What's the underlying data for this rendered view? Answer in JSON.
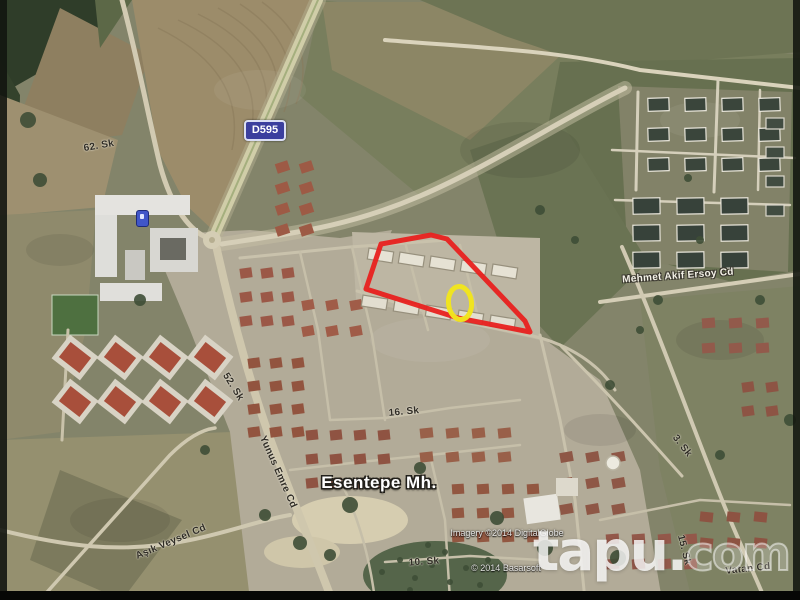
{
  "map": {
    "route_badge": {
      "label": "D595",
      "bg_color": "#3b3f9e"
    },
    "neighborhood": {
      "label": "Esentepe Mh."
    },
    "streets": [
      {
        "id": "62-sk",
        "label": "62. Sk"
      },
      {
        "id": "52-sk",
        "label": "52. Sk"
      },
      {
        "id": "yunus-emre",
        "label": "Yunus Emre Cd"
      },
      {
        "id": "16-sk",
        "label": "16. Sk"
      },
      {
        "id": "10-sk",
        "label": "10. Sk"
      },
      {
        "id": "asik-veysel",
        "label": "Aşık Veysel Cd"
      },
      {
        "id": "mehmet-akif",
        "label": "Mehmet Akif Ersoy Cd"
      },
      {
        "id": "3-sk",
        "label": "3. Sk"
      },
      {
        "id": "15-sk",
        "label": "15. Sk"
      },
      {
        "id": "vatan",
        "label": "Vatan Cd"
      }
    ],
    "annotations": {
      "parcel_outline_color": "#e8211f",
      "marker_ring_color": "#f2e51d",
      "poi_icon": "blue-place-marker"
    },
    "attribution": {
      "imagery": "Imagery ©2014 DigitalGlobe",
      "mapdata": "© 2014 Basarsoft"
    },
    "watermark": {
      "brand": "tapu",
      "dot": ".",
      "tld": "com"
    }
  }
}
